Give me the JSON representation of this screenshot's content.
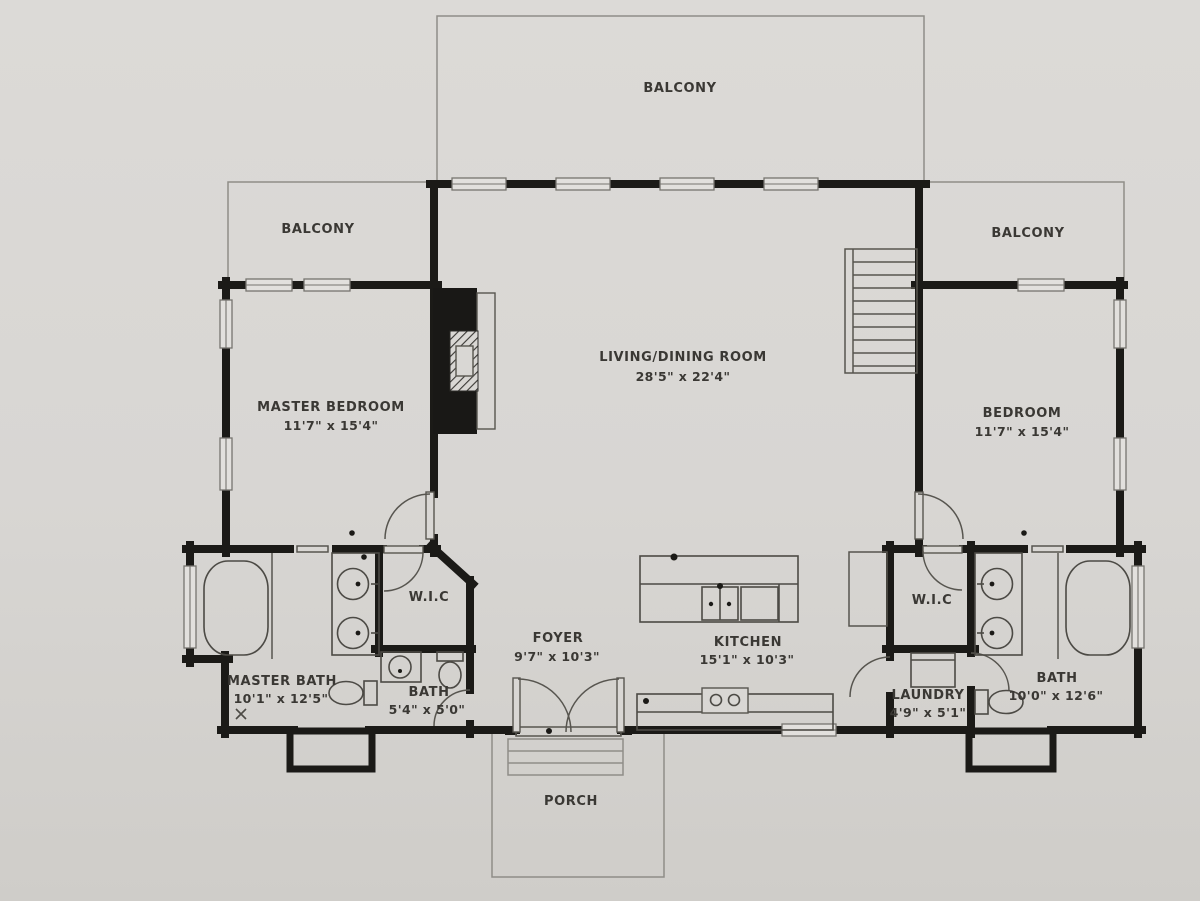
{
  "plan": {
    "rooms": {
      "balcony_top": {
        "name": "BALCONY"
      },
      "balcony_left": {
        "name": "BALCONY"
      },
      "balcony_right": {
        "name": "BALCONY"
      },
      "living_dining": {
        "name": "LIVING/DINING ROOM",
        "dims": "28'5\" x 22'4\""
      },
      "master_bedroom": {
        "name": "MASTER BEDROOM",
        "dims": "11'7\" x 15'4\""
      },
      "bedroom": {
        "name": "BEDROOM",
        "dims": "11'7\" x 15'4\""
      },
      "wic_left": {
        "name": "W.I.C"
      },
      "wic_right": {
        "name": "W.I.C"
      },
      "foyer": {
        "name": "FOYER",
        "dims": "9'7\" x 10'3\""
      },
      "kitchen": {
        "name": "KITCHEN",
        "dims": "15'1\" x 10'3\""
      },
      "master_bath": {
        "name": "MASTER BATH",
        "dims": "10'1\" x 12'5\""
      },
      "bath_small": {
        "name": "BATH",
        "dims": "5'4\" x 5'0\""
      },
      "laundry": {
        "name": "LAUNDRY",
        "dims": "4'9\" x 5'1\""
      },
      "bath_right": {
        "name": "BATH",
        "dims": "10'0\" x 12'6\""
      },
      "porch": {
        "name": "PORCH"
      }
    },
    "colors": {
      "paper": "#d9d7d4",
      "wall": "#1b1a17",
      "thin_line": "#57554f",
      "text": "#3a3834"
    }
  }
}
